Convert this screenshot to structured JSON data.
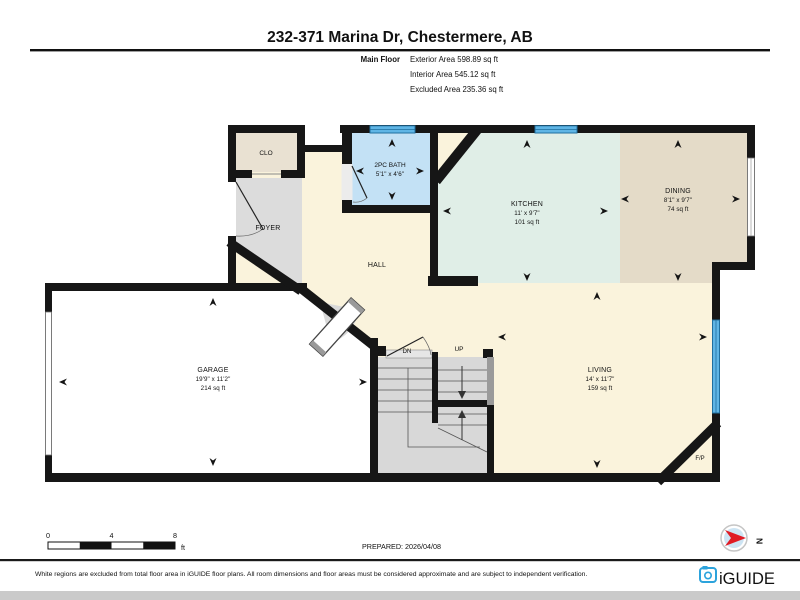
{
  "header": {
    "title": "232-371 Marina Dr, Chestermere, AB",
    "floor_label": "Main Floor",
    "area_lines": [
      "Exterior Area 598.89 sq ft",
      "Interior Area 545.12 sq ft",
      "Excluded Area 235.36 sq ft"
    ]
  },
  "rooms": {
    "clo": {
      "name": "CLO"
    },
    "foyer": {
      "name": "FOYER"
    },
    "bath": {
      "name": "2PC BATH",
      "dims": "5'1\" x 4'6\""
    },
    "hall": {
      "name": "HALL"
    },
    "kitchen": {
      "name": "KITCHEN",
      "dims": "11' x 9'7\"",
      "area": "101 sq ft"
    },
    "dining": {
      "name": "DINING",
      "dims": "8'1\" x 9'7\"",
      "area": "74 sq ft"
    },
    "garage": {
      "name": "GARAGE",
      "dims": "19'9\" x 11'2\"",
      "area": "214 sq ft"
    },
    "living": {
      "name": "LIVING",
      "dims": "14' x 11'7\"",
      "area": "159 sq ft"
    },
    "fireplace": {
      "name": "F/P"
    },
    "stairs": {
      "down": "DN",
      "up": "UP"
    }
  },
  "scale_bar": {
    "ticks": [
      "0",
      "4",
      "8"
    ],
    "unit": "ft"
  },
  "footer": {
    "prepared": "PREPARED: 2026/04/08",
    "disclaimer": "White regions are excluded from total floor area in iGUIDE floor plans. All room dimensions and floor areas must be considered approximate and are subject to independent verification.",
    "brand": "iGUIDE",
    "compass_letter": "N"
  },
  "colors": {
    "wall": "#161616",
    "cream": "#faf3dc",
    "mint": "#e0eee7",
    "tan": "#e4dbc8",
    "clotan": "#e9e1d2",
    "gray": "#dcdcdc",
    "stair": "#d8d8d8",
    "bath": "#c3e1f5",
    "winfill": "#5fb5e5",
    "winline": "#1f6f9f",
    "brand": "#2ca3dc",
    "red": "#e01b24"
  }
}
